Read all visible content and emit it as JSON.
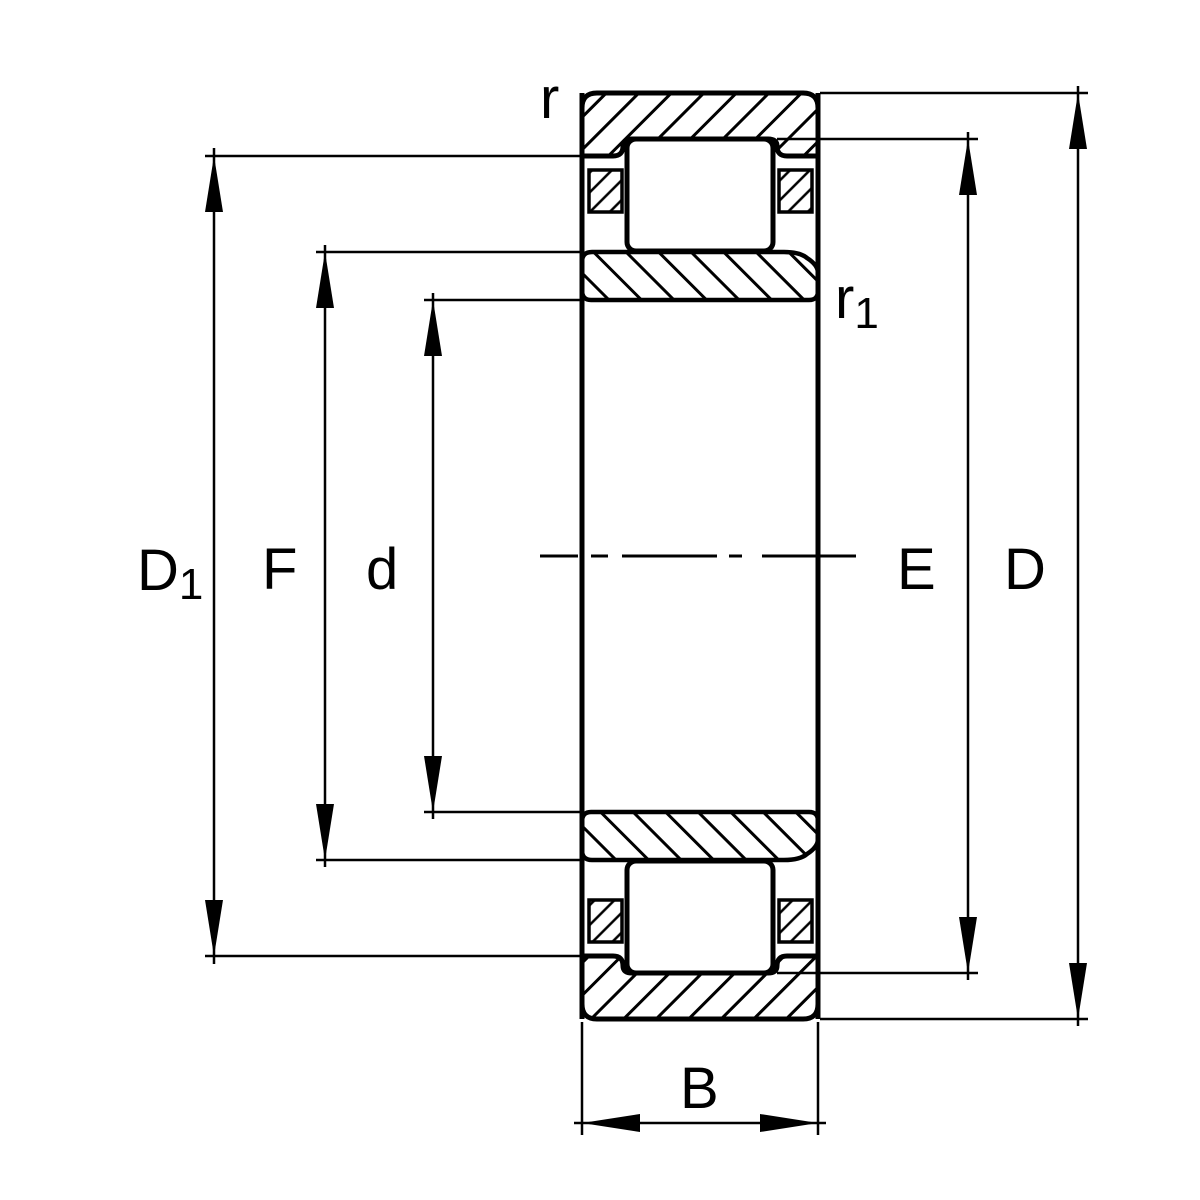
{
  "drawing": {
    "kind": "cylindrical-roller-bearing-cross-section",
    "colors": {
      "line": "#000000",
      "background": "#ffffff"
    },
    "labels": {
      "outer_land_diameter": {
        "main": "D",
        "sub": "1"
      },
      "inner_raceway_diameter": {
        "main": "F"
      },
      "bore_diameter": {
        "main": "d"
      },
      "outer_raceway_diameter": {
        "main": "E"
      },
      "outside_diameter": {
        "main": "D"
      },
      "width": {
        "main": "B"
      },
      "chamfer_outer": {
        "main": "r"
      },
      "chamfer_inner": {
        "main": "r",
        "sub": "1"
      }
    }
  }
}
